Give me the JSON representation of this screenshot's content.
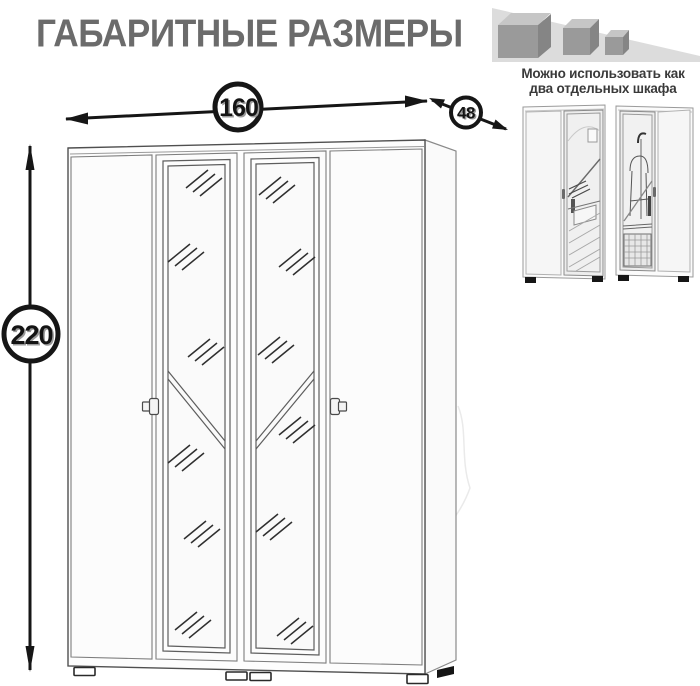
{
  "title": "ГАБАРИТНЫЕ РАЗМЕРЫ",
  "logo": {
    "icon": "shrinking-cubes-icon"
  },
  "note": {
    "line1": "Можно использовать как",
    "line2": "два отдельных шкафа"
  },
  "dimensions": {
    "width": "160",
    "depth": "48",
    "height": "220"
  },
  "drawing": {
    "type": "wardrobe-dimension-diagram",
    "doors": 4,
    "mirror_doors": 2
  },
  "colors": {
    "title": "#6b6b6b",
    "note": "#3a3a3a",
    "line": "#161616",
    "logo_triangle": "#dcdcdc",
    "cube_front": "#9a9a9a",
    "cube_top": "#c6c6c6",
    "cube_side": "#858585"
  }
}
